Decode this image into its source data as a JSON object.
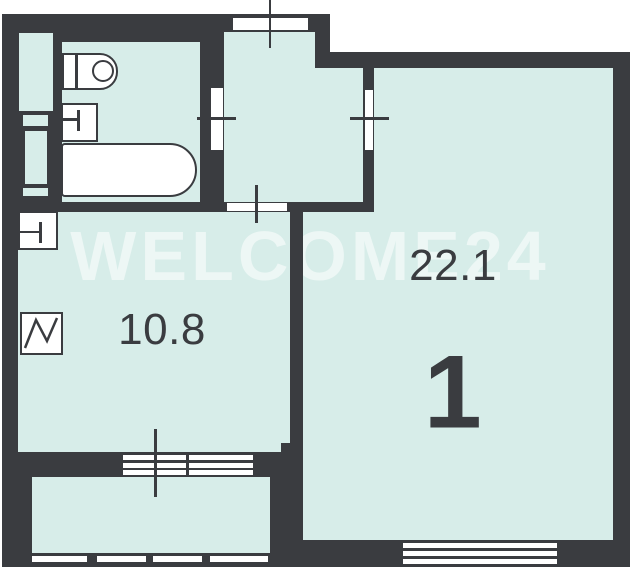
{
  "floor_plan": {
    "watermark": "WELCOME24",
    "living_room": {
      "area_label": "22.1",
      "room_number": "1"
    },
    "kitchen": {
      "area_label": "10.8"
    },
    "colors": {
      "wall": "#3a3c40",
      "room_fill": "#d7ede9",
      "fixture_fill": "#ffffff",
      "label_text": "#3a3c40",
      "watermark_text": "rgba(255,255,255,0.55)"
    },
    "symbols": [
      "toilet-symbol",
      "washbasin-symbol",
      "bathtub-symbol",
      "kitchen-sink-symbol",
      "vent-shaft-symbol"
    ]
  }
}
